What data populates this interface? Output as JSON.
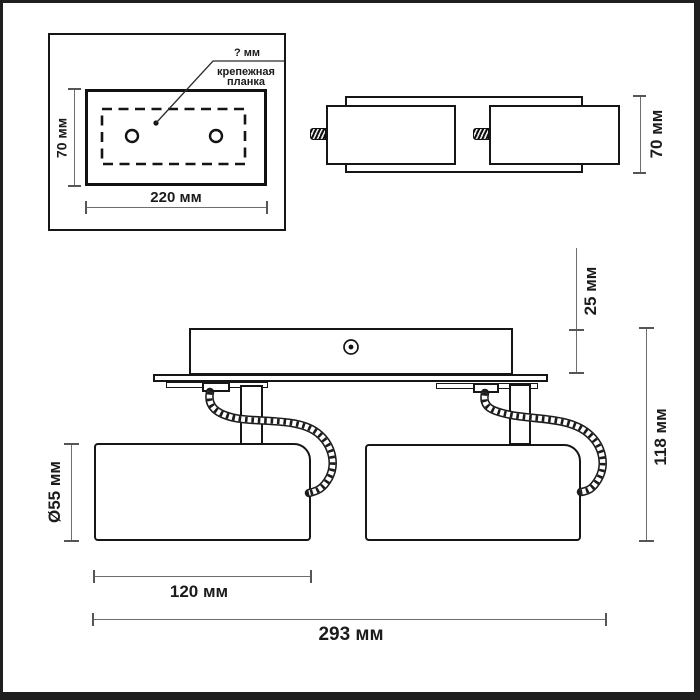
{
  "drawing": {
    "detail_box": {
      "callout_dim": "? мм",
      "callout_label_line1": "крепежная",
      "callout_label_line2": "планка",
      "height_dim": "70 мм",
      "width_dim": "220 мм"
    },
    "side_view": {
      "height_dim": "70 мм"
    },
    "front_view": {
      "canopy_depth_dim": "25 мм",
      "overall_height_dim": "118 мм",
      "shade_diameter_dim": "Ø55 мм",
      "shade_length_dim": "120 мм",
      "overall_width_dim": "293 мм"
    },
    "colors": {
      "line": "#161616",
      "dimension_line": "#6e6e6e",
      "background": "#ffffff"
    }
  }
}
